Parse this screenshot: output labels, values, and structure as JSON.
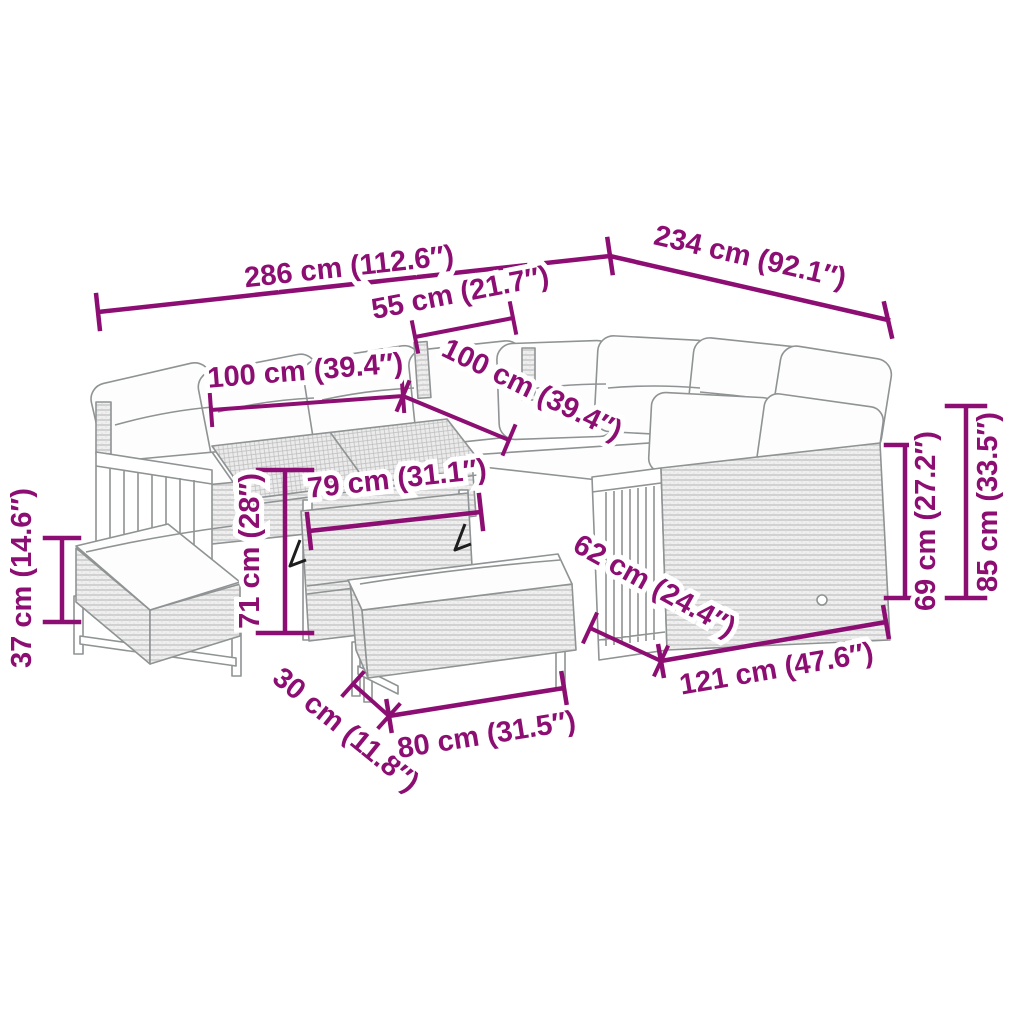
{
  "diagram": {
    "kind": "furniture-dimension-diagram",
    "subject": "outdoor-rattan-lounge-set-with-table-and-benches",
    "colors": {
      "dimension_accent": "#8D0E72",
      "line_art": "#8f9393",
      "background": "#ffffff"
    },
    "dimensions": [
      {
        "id": "overall-width-front",
        "label": "286 cm (112.6″)"
      },
      {
        "id": "overall-depth-right",
        "label": "234 cm (92.1″)"
      },
      {
        "id": "corner-seat-width",
        "label": "55 cm (21.7″)"
      },
      {
        "id": "left-seat-width",
        "label": "100 cm (39.4″)"
      },
      {
        "id": "right-seat-width",
        "label": "100 cm (39.4″)"
      },
      {
        "id": "table-top-width",
        "label": "79 cm (31.1″)"
      },
      {
        "id": "table-height",
        "label": "71 cm (28″)"
      },
      {
        "id": "bench-height",
        "label": "37 cm (14.6″)"
      },
      {
        "id": "bench-depth",
        "label": "30 cm (11.8″)"
      },
      {
        "id": "bench-length",
        "label": "80 cm (31.5″)"
      },
      {
        "id": "sofa-seat-depth",
        "label": "62 cm (24.4″)"
      },
      {
        "id": "sofa-module-length",
        "label": "121 cm (47.6″)"
      },
      {
        "id": "seat-back-height",
        "label": "69 cm (27.2″)"
      },
      {
        "id": "total-height",
        "label": "85 cm (33.5″)"
      }
    ]
  }
}
